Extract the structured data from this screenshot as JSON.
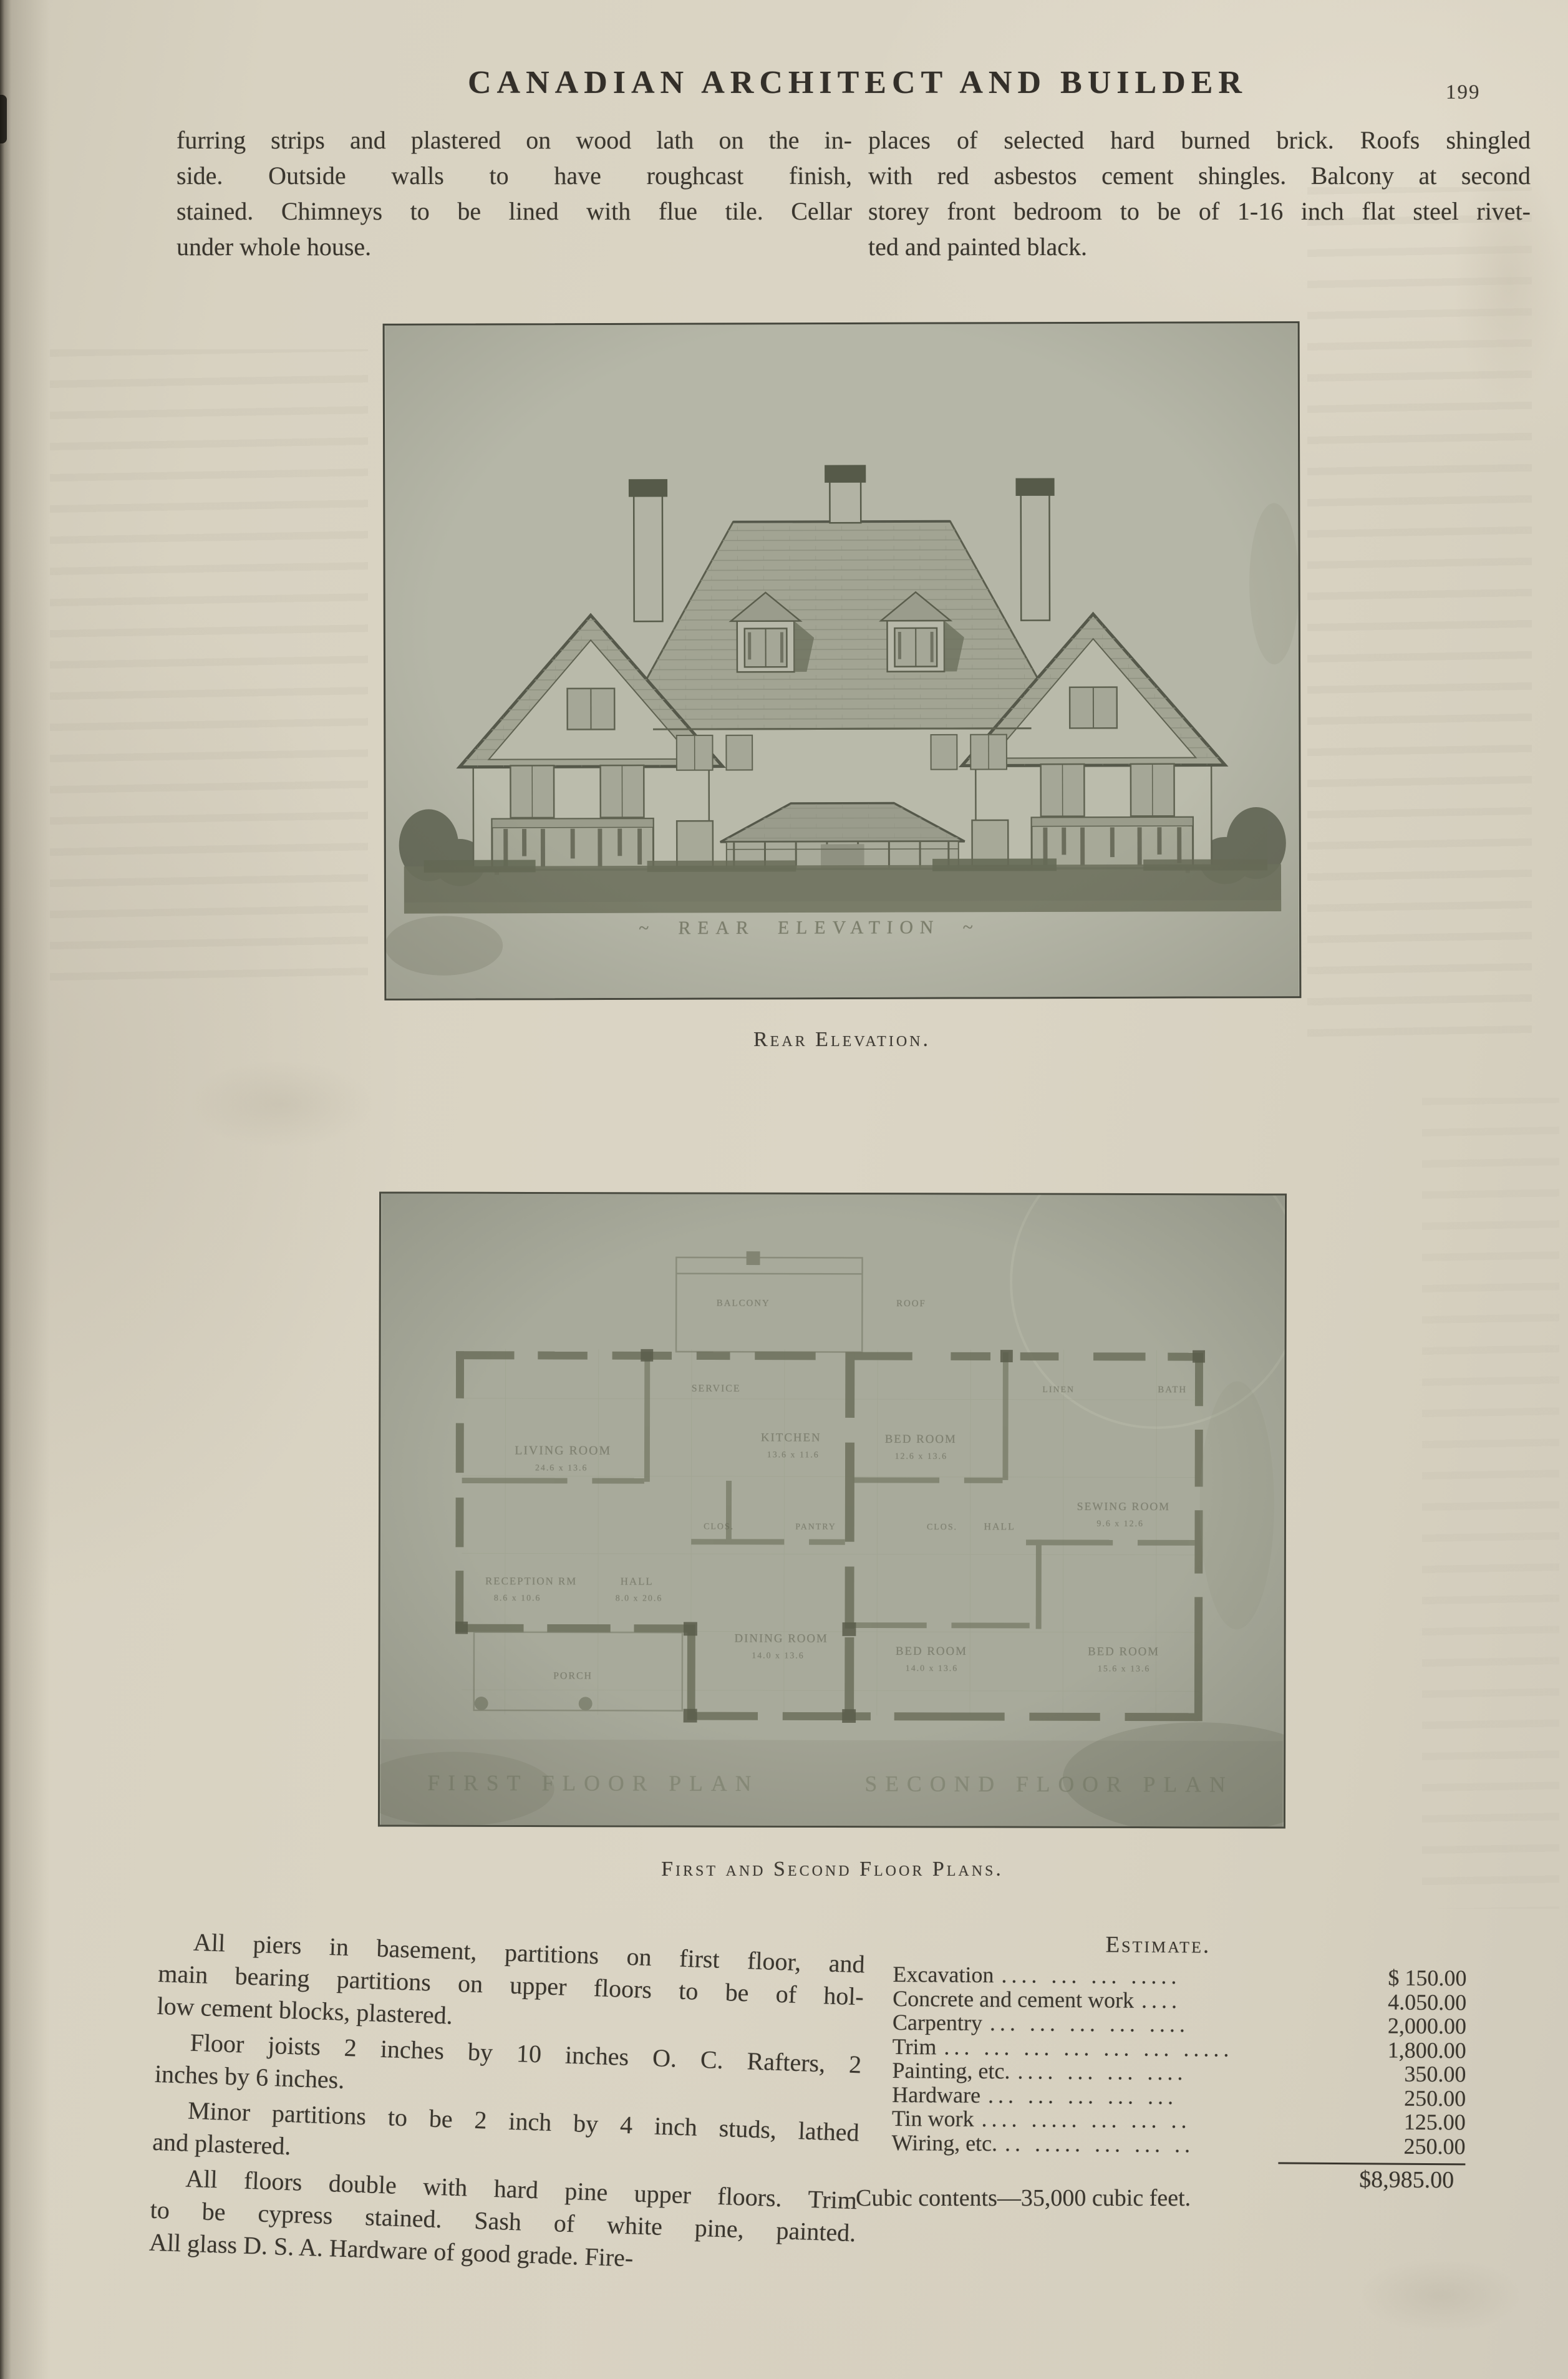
{
  "header": {
    "title": "CANADIAN ARCHITECT AND BUILDER",
    "page_number": "199"
  },
  "intro_left": {
    "lines": [
      "furring strips and plastered on wood lath on the in-",
      "side. Outside walls to have roughcast finish,",
      "stained. Chimneys to be lined with flue tile. Cellar",
      "under whole house."
    ]
  },
  "intro_right": {
    "lines": [
      "places of selected hard burned brick. Roofs shingled",
      "with red asbestos cement shingles. Balcony at second",
      "storey front bedroom to be of 1-16 inch flat steel rivet-",
      "ted and painted black."
    ]
  },
  "figures": {
    "elevation": {
      "caption": "Rear Elevation.",
      "drawn_label": "~ REAR  ELEVATION ~"
    },
    "plans": {
      "caption": "First and Second Floor Plans.",
      "label_first": "FIRST  FLOOR  PLAN",
      "label_second": "SECOND  FLOOR  PLAN",
      "rooms": [
        {
          "name": "LIVING ROOM",
          "dims": "24.6 x 13.6"
        },
        {
          "name": "SERVICE",
          "dims": ""
        },
        {
          "name": "KITCHEN",
          "dims": "13.6 x 11.6"
        },
        {
          "name": "RECEPTION RM",
          "dims": "8.6 x 10.6"
        },
        {
          "name": "HALL",
          "dims": "8.0 x 20.6"
        },
        {
          "name": "DINING ROOM",
          "dims": "14.0 x 13.6"
        },
        {
          "name": "PORCH",
          "dims": ""
        },
        {
          "name": "CLOS.",
          "dims": ""
        },
        {
          "name": "PANTRY",
          "dims": ""
        },
        {
          "name": "BALCONY",
          "dims": ""
        },
        {
          "name": "ROOF",
          "dims": ""
        },
        {
          "name": "BED ROOM",
          "dims": "12.6 x 13.6"
        },
        {
          "name": "SEWING ROOM",
          "dims": "9.6 x 12.6"
        },
        {
          "name": "BED ROOM",
          "dims": "14.0 x 13.6"
        },
        {
          "name": "BED ROOM",
          "dims": "15.6 x 13.6"
        },
        {
          "name": "BATH",
          "dims": ""
        },
        {
          "name": "HALL",
          "dims": ""
        },
        {
          "name": "CLOS.",
          "dims": ""
        },
        {
          "name": "LINEN",
          "dims": ""
        }
      ]
    }
  },
  "spec": {
    "p1": [
      "All piers in basement, partitions on first floor, and",
      "main bearing partitions on upper floors to be of hol-",
      "low cement blocks, plastered."
    ],
    "p2": [
      "Floor joists 2 inches by 10 inches O. C. Rafters, 2",
      "inches by 6 inches."
    ],
    "p3": [
      "Minor partitions to be 2 inch by 4 inch studs, lathed",
      "and plastered."
    ],
    "p4": [
      "All floors double with hard pine upper floors. Trim",
      "to be cypress stained. Sash of white pine, painted.",
      "All glass D. S. A. Hardware of good grade. Fire-"
    ]
  },
  "estimate": {
    "title": "Estimate.",
    "rows": [
      {
        "label": "Excavation",
        "dots": ".... ... ... .....",
        "amount": "$ 150.00"
      },
      {
        "label": "Concrete and cement work",
        "dots": "....",
        "amount": "4.050.00"
      },
      {
        "label": "Carpentry",
        "dots": "... ... ... ... ....",
        "amount": "2,000.00"
      },
      {
        "label": "Trim",
        "dots": "... ... ... ... ... ... .....",
        "amount": "1,800.00"
      },
      {
        "label": "Painting, etc.",
        "dots": ".... ... ... ....",
        "amount": "350.00"
      },
      {
        "label": "Hardware",
        "dots": "... ... ... ... ...",
        "amount": "250.00"
      },
      {
        "label": "Tin work",
        "dots": ".... ..... ... ... ..",
        "amount": "125.00"
      },
      {
        "label": "Wiring, etc.",
        "dots": ".. ..... ... ... ..",
        "amount": "250.00"
      }
    ],
    "total": "$8,985.00",
    "footnote": "Cubic contents—35,000 cubic feet."
  }
}
